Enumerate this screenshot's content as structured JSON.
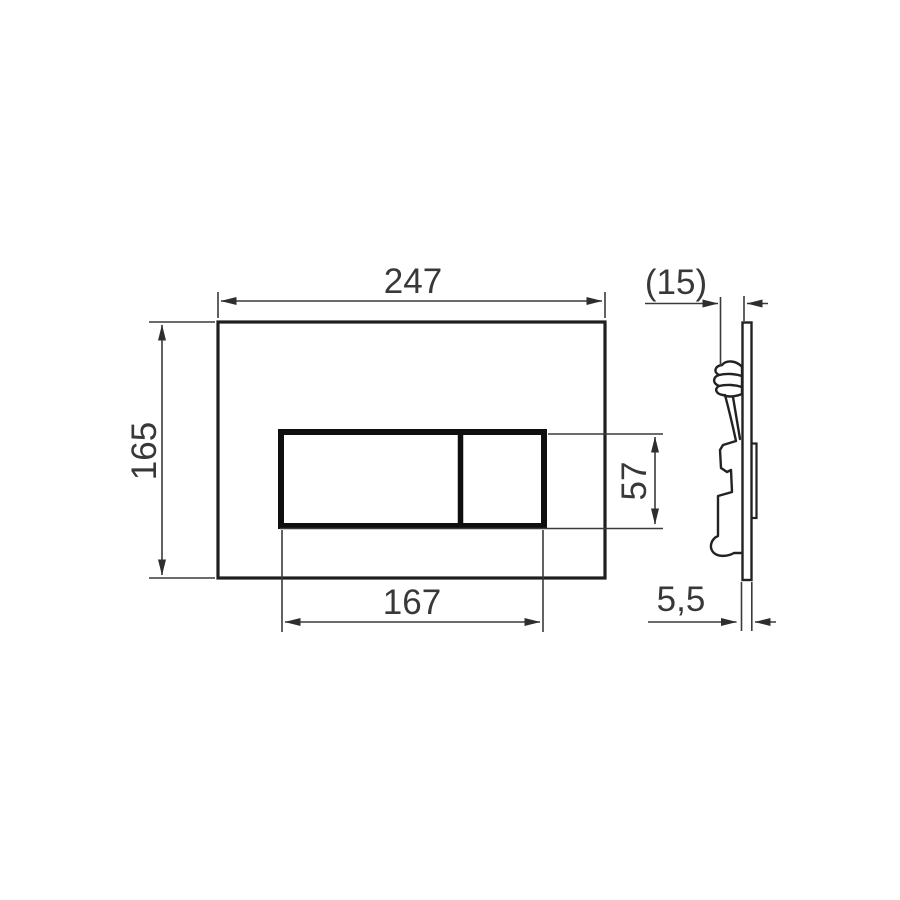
{
  "drawing": {
    "kind": "flush-plate-dimension-drawing",
    "front_view": {
      "plate_width_mm": "247",
      "plate_height_mm": "165",
      "button_panel_width_mm": "167",
      "button_panel_height_mm": "57"
    },
    "side_view": {
      "mounting_depth_mm": "(15)",
      "plate_thickness_mm": "5,5"
    },
    "colors": {
      "background": "#ffffff",
      "line": "#2e2e2e",
      "text": "#383838"
    }
  }
}
